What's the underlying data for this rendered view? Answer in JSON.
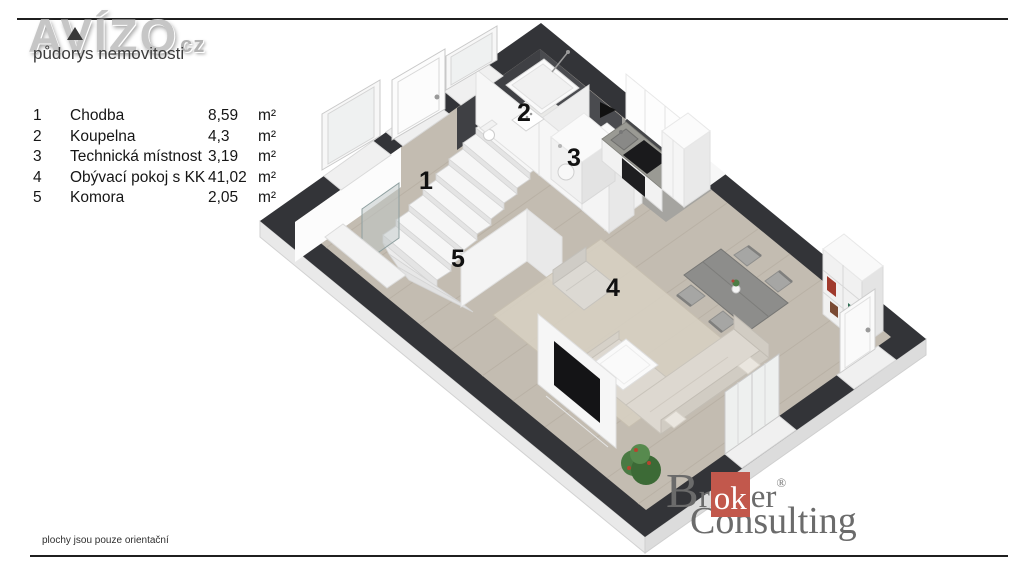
{
  "brand": {
    "logo_text": "AVÍZO",
    "logo_tld": "cz",
    "tagline": "půdorys nemovitosti"
  },
  "legend": {
    "unit_label": "m²",
    "rooms": [
      {
        "number": "1",
        "name": "Chodba",
        "area": "8,59"
      },
      {
        "number": "2",
        "name": "Koupelna",
        "area": "4,3"
      },
      {
        "number": "3",
        "name": "Technická místnost",
        "area": "3,19"
      },
      {
        "number": "4",
        "name": "Obývací pokoj s KK",
        "area": "41,02"
      },
      {
        "number": "5",
        "name": "Komora",
        "area": "2,05"
      }
    ]
  },
  "footer": {
    "disclaimer": "plochy jsou pouze orientační"
  },
  "partner": {
    "initial": "B",
    "line1_pre": "r",
    "highlight": "ok",
    "line1_post": "er",
    "registered": "®",
    "line2": "Consulting"
  },
  "colors": {
    "wall_dark": "#333438",
    "floor_wood": "#c3bcb1",
    "floor_tile": "#a5a4a0",
    "accent_red": "#c2584c",
    "logo_gray": "#c6c6c6"
  }
}
